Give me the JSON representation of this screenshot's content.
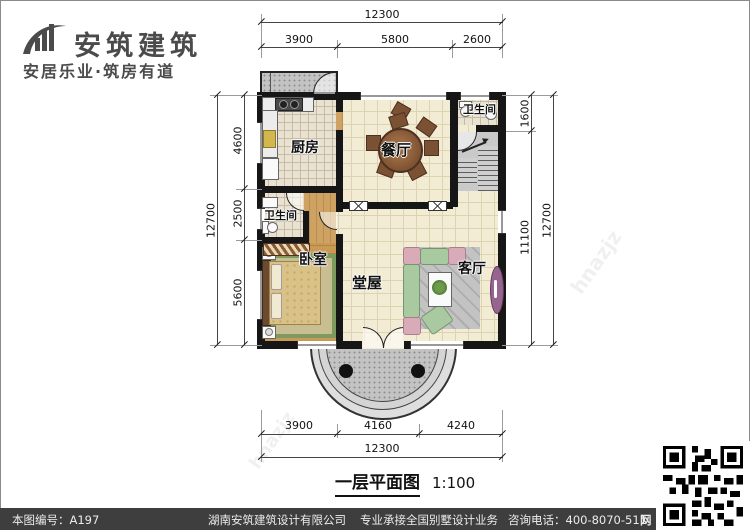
{
  "logo": {
    "name": "安筑建筑",
    "tagline": "安居乐业·筑房有道"
  },
  "plan": {
    "rooms": {
      "kitchen": "厨房",
      "dining": "餐厅",
      "bath_top": "卫生间",
      "bath_left": "卫生间",
      "bedroom": "卧室",
      "hall": "堂屋",
      "living": "客厅"
    },
    "dims": {
      "top_total": "12300",
      "top_segments": [
        "3900",
        "5800",
        "2600"
      ],
      "left_total": "12700",
      "left_segments": [
        "4600",
        "2500",
        "5600"
      ],
      "right_total": "12700",
      "right_segments": [
        "1600",
        "11100"
      ],
      "bottom_total": "12300",
      "bottom_segments": [
        "3900",
        "4160",
        "4240"
      ]
    },
    "watermark_cn": "安筑建筑",
    "watermark_en": "hnazjz"
  },
  "caption": {
    "title": "一层平面图",
    "scale": "1:100"
  },
  "footer": {
    "drawing_no": "本图编号：A197",
    "company": "湖南安筑建筑设计有限公司",
    "service": "专业承接全国别墅设计业务",
    "phone": "咨询电话：400-8070-511",
    "web_icon": "网"
  },
  "colors": {
    "wall": "#161616",
    "floor": "#f3ecd4",
    "bar": "#3e3e3e",
    "logo": "#4b4b4b"
  }
}
